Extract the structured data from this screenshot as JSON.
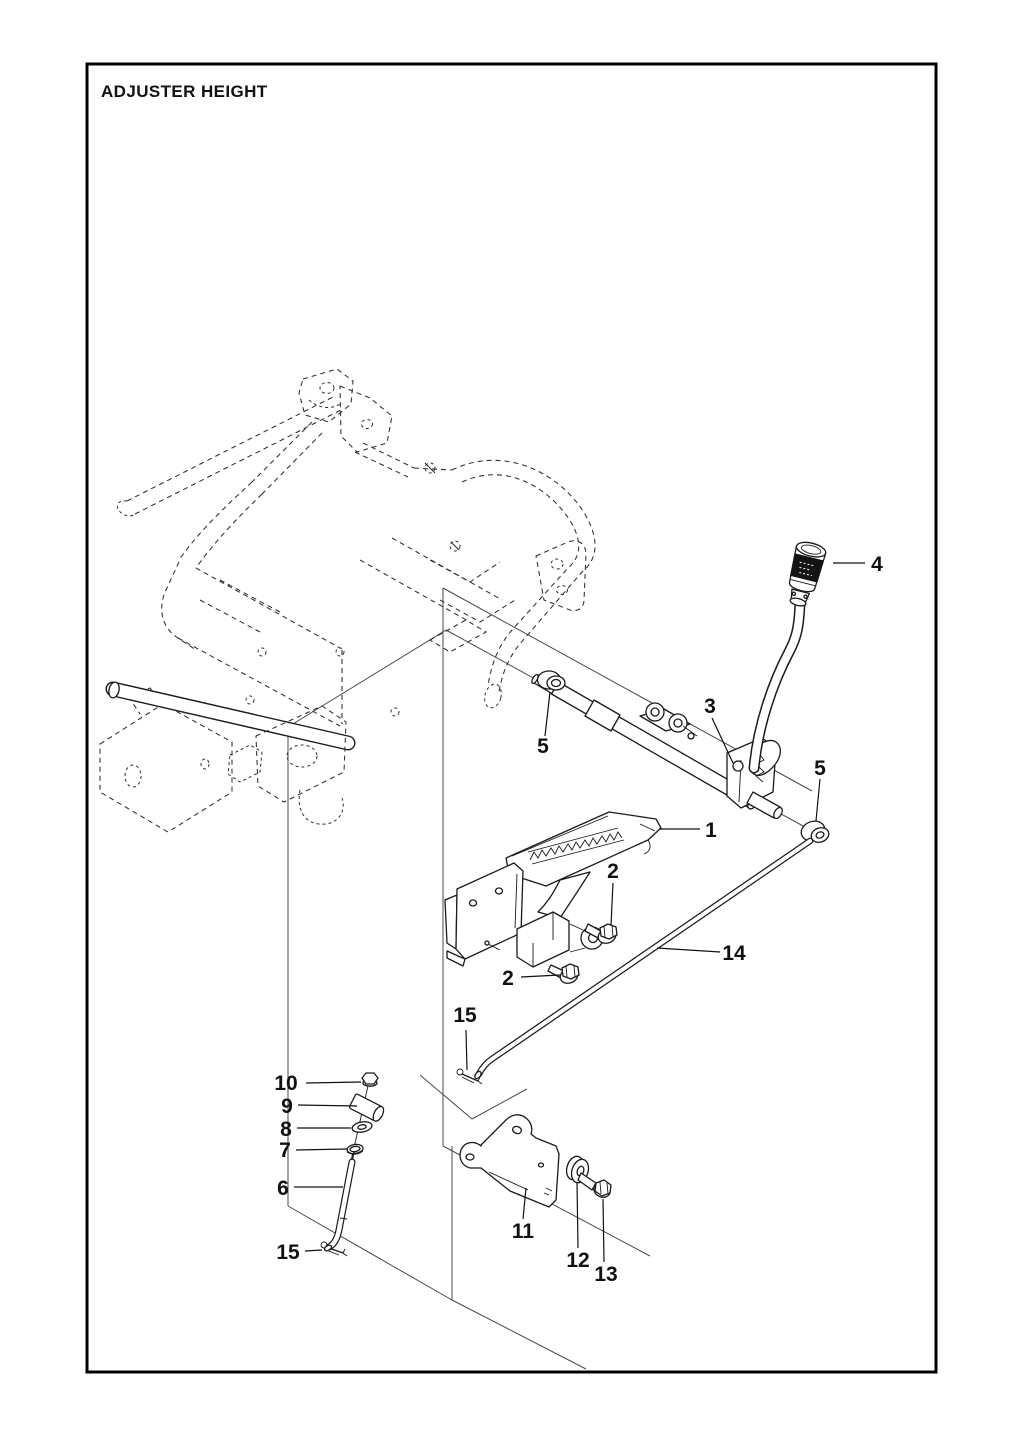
{
  "page": {
    "title": "ADJUSTER HEIGHT"
  },
  "callouts": {
    "c1": "1",
    "c2": "2",
    "c3": "3",
    "c4": "4",
    "c5": "5",
    "c6": "6",
    "c7": "7",
    "c8": "8",
    "c9": "9",
    "c10": "10",
    "c11": "11",
    "c12": "12",
    "c13": "13",
    "c14": "14",
    "c15": "15"
  }
}
